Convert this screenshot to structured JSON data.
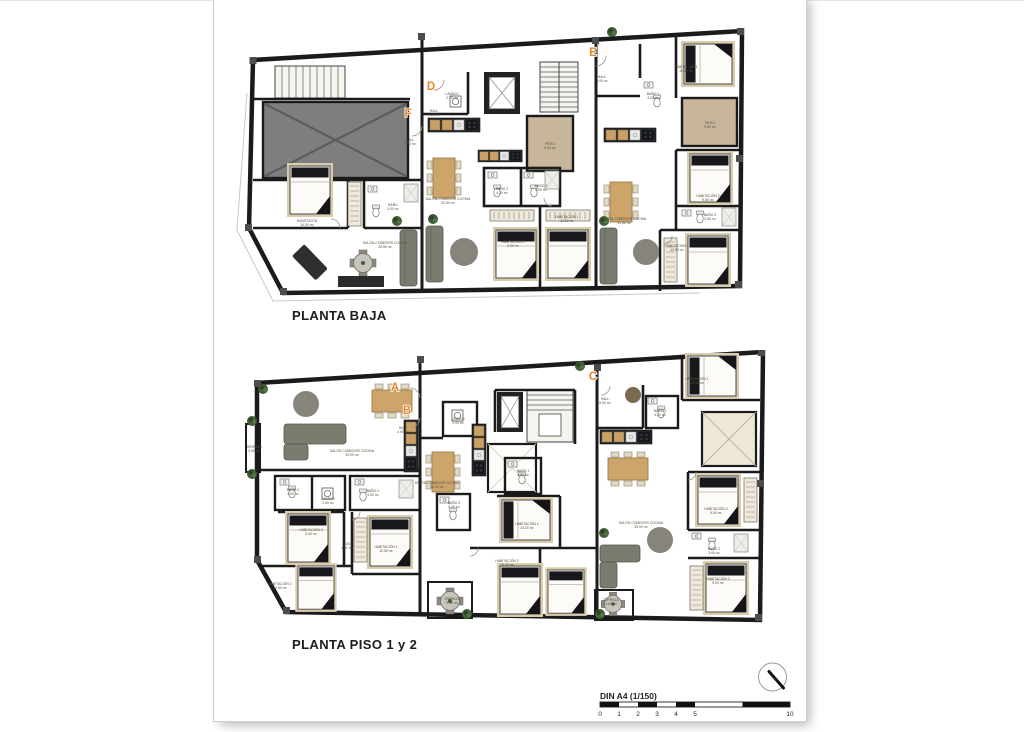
{
  "plans": [
    {
      "id": "planta-baja",
      "title": "PLANTA BAJA",
      "apartment_letters": [
        {
          "letter": "F",
          "x": 408,
          "y": 117
        },
        {
          "letter": "D",
          "x": 431,
          "y": 90
        },
        {
          "letter": "E",
          "x": 593,
          "y": 56
        }
      ],
      "rooms": [
        {
          "name": "HALL",
          "area": "3.50 m²",
          "x": 410,
          "y": 141
        },
        {
          "name": "BAÑO",
          "area": "3.00 m²",
          "x": 393,
          "y": 206
        },
        {
          "name": "HABITACIÓN",
          "area": "10.50 m²",
          "x": 307,
          "y": 222
        },
        {
          "name": "SALÓN-COMEDOR COCINA",
          "area": "26.55 m²",
          "x": 385,
          "y": 244
        },
        {
          "name": "LAVADO",
          "area": "2.70 m²",
          "x": 452,
          "y": 95
        },
        {
          "name": "HALL",
          "area": "7.00 m²",
          "x": 434,
          "y": 112
        },
        {
          "name": "SALÓN-COMEDOR COCINA",
          "area": "52.50 m²",
          "x": 448,
          "y": 200
        },
        {
          "name": "PATIO",
          "area": "9.00 m²",
          "x": 550,
          "y": 145
        },
        {
          "name": "BAÑO 2",
          "area": "4.20 m²",
          "x": 502,
          "y": 190
        },
        {
          "name": "BAÑO 1",
          "area": "4.50 m²",
          "x": 541,
          "y": 187
        },
        {
          "name": "HABITACIÓN 1",
          "area": "12.50 m²",
          "x": 567,
          "y": 218
        },
        {
          "name": "HABITACIÓN 2",
          "area": "9.00 m²",
          "x": 513,
          "y": 243
        },
        {
          "name": "HALL",
          "area": "5.00 m²",
          "x": 602,
          "y": 78
        },
        {
          "name": "BAÑO 1",
          "area": "4.20 m²",
          "x": 653,
          "y": 95
        },
        {
          "name": "HABITACIÓN 1",
          "area": "10.50 m²",
          "x": 686,
          "y": 68
        },
        {
          "name": "PATIO",
          "area": "9.50 m²",
          "x": 710,
          "y": 124
        },
        {
          "name": "SALÓN-COMEDOR COCINA",
          "area": "31.50 m²",
          "x": 624,
          "y": 220
        },
        {
          "name": "HABITACIÓN 2",
          "area": "9.50 m²",
          "x": 708,
          "y": 197
        },
        {
          "name": "BAÑO 2",
          "area": "3.60 m²",
          "x": 710,
          "y": 216
        },
        {
          "name": "HABITACIÓN 3",
          "area": "10.50 m²",
          "x": 677,
          "y": 247
        }
      ]
    },
    {
      "id": "planta-piso-1-y-2",
      "title": "PLANTA PISO 1 y 2",
      "apartment_letters": [
        {
          "letter": "A",
          "x": 395,
          "y": 391
        },
        {
          "letter": "B",
          "x": 407,
          "y": 414
        },
        {
          "letter": "C",
          "x": 593,
          "y": 380
        }
      ],
      "rooms": [
        {
          "name": "HALL",
          "area": "2.00 m²",
          "x": 403,
          "y": 429
        },
        {
          "name": "TERRAZA",
          "area": "4.00 m²",
          "x": 254,
          "y": 448
        },
        {
          "name": "SALÓN COMEDOR COCINA",
          "area": "29.00 m²",
          "x": 352,
          "y": 452
        },
        {
          "name": "BAÑO 2",
          "area": "4.00 m²",
          "x": 293,
          "y": 491
        },
        {
          "name": "LAVADO",
          "area": "2.50 m²",
          "x": 328,
          "y": 500
        },
        {
          "name": "BAÑO 1",
          "area": "4.50 m²",
          "x": 373,
          "y": 492
        },
        {
          "name": "HABITACIÓN 3",
          "area": "9.40 m²",
          "x": 311,
          "y": 531
        },
        {
          "name": "PASO",
          "area": "4.50 m²",
          "x": 347,
          "y": 545
        },
        {
          "name": "HABITACIÓN 1",
          "area": "10.50 m²",
          "x": 386,
          "y": 548
        },
        {
          "name": "HABITACIÓN 2",
          "area": "10.50 m²",
          "x": 280,
          "y": 585
        },
        {
          "name": "LAVADO",
          "area": "2.00 m²",
          "x": 458,
          "y": 420
        },
        {
          "name": "SALÓN-COMEDOR COCINA",
          "area": "30.00 m²",
          "x": 437,
          "y": 484
        },
        {
          "name": "BAÑO 2",
          "area": "4.20 m²",
          "x": 454,
          "y": 504
        },
        {
          "name": "BAÑO 1",
          "area": "4.50 m²",
          "x": 523,
          "y": 472
        },
        {
          "name": "HABITACIÓN 1",
          "area": "14.20 m²",
          "x": 527,
          "y": 525
        },
        {
          "name": "HABITACIÓN 2",
          "area": "10.50 m²",
          "x": 507,
          "y": 562
        },
        {
          "name": "TERRAZA",
          "area": "5.50 m²",
          "x": 452,
          "y": 600
        },
        {
          "name": "HALL",
          "area": "5.00 m²",
          "x": 605,
          "y": 400
        },
        {
          "name": "BAÑO 1",
          "area": "4.20 m²",
          "x": 660,
          "y": 412
        },
        {
          "name": "HABITACIÓN 1",
          "area": "10.50 m²",
          "x": 697,
          "y": 380
        },
        {
          "name": "SALÓN COMEDOR COCINA",
          "area": "33.00 m²",
          "x": 641,
          "y": 524
        },
        {
          "name": "HABITACIÓN 3",
          "area": "9.60 m²",
          "x": 716,
          "y": 510
        },
        {
          "name": "BAÑO 2",
          "area": "3.60 m²",
          "x": 714,
          "y": 550
        },
        {
          "name": "HABITACIÓN 2",
          "area": "9.20 m²",
          "x": 718,
          "y": 580
        },
        {
          "name": "TERRAZA",
          "area": "4.60 m²",
          "x": 611,
          "y": 601
        }
      ]
    }
  ],
  "scale_bar": {
    "label": "DIN A4 (1/150)",
    "units": [
      0,
      1,
      2,
      3,
      4,
      5,
      10
    ],
    "x0": 600,
    "x1": 790,
    "max": 10
  },
  "north_indicator": {
    "name": "orientation-compass"
  },
  "colors": {
    "accent_letter": "#e8862a",
    "wall": "#1b1b1b",
    "floor": "#eae2d2",
    "patio": "#c7b69b",
    "label_text": "#56503f"
  }
}
